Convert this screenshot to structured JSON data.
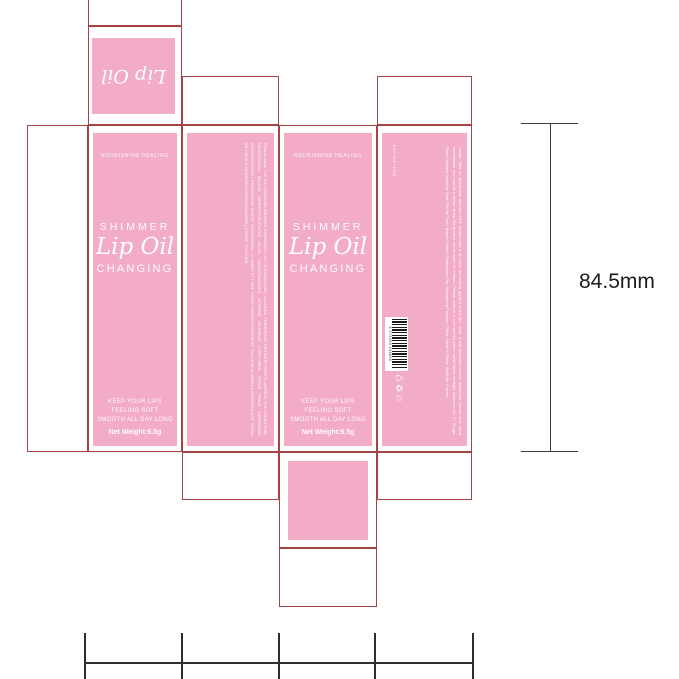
{
  "colors": {
    "panel_pink": "#F2ACC8",
    "dieline_red": "#a54444",
    "dimension_gray": "#3a3a3a"
  },
  "top_flap": {
    "brand_script": "Lip Oil"
  },
  "front_panel": {
    "tagline": "NOURISHING HEALING",
    "shimmer": "SHIMMER",
    "brand_script": "Lip Oil",
    "changing": "CHANGING",
    "claims": [
      "KEEP YOUR LIPS",
      "FEELING SOFT",
      "SMOOTH ALL DAY LONG"
    ],
    "net_weight": "Net Weight:6.5g"
  },
  "ingredients_panel": {
    "text": "Product name : LIP OIL CHANGING SHIMMER   INGREDIENT: OCTYLDODECANOL, ALCOHOL, TRIBEHENIN, PENTAERYTHRITYL ADIPATE, POLYISOBUTENE, DIISOSTEARYL MALATE, DIMETHYLSILYLATED SILICA, DIISOSTEARATES, STYRENE ISOPRENE COPOLYMER, OTHER TRACE INGREDIENT: HYDROXYPHENYL PROPIONATE ESTER, TOCOPHEROL, CI 15850, CI 77491, FOOD FLAVOR   INGREDIENT: CALCIUM ALUMINUM BOROSILICATE, TETRA (DI-T-BUTYL HYDROXYHYDROCINNAMATE), ESTER, TIN OXIDE"
  },
  "info_panel": {
    "usage_text": "Usage: Take an appropriate amount of this product with a lip brush and evenly apply it to the lips. Note: If any discomfort occurs during use, please stop using immediately and consult a doctor. Keep this product out of reach of children. Please store in a cool and dry place, avoid direct sunlight. Address: No. 17 Xingye Road, Xinhang Industrial Zone, Renhe Town, Baiyun District, Guangzhou City, Guangdong Province, China. Made in China. Shelf life: 3 years.",
    "exp_code": "EXP:20271006",
    "barcode_digits": "6 972493 216890",
    "icons": {
      "green_dot": "♺",
      "recycle": "♻",
      "dispose": "♲"
    }
  },
  "dimensions": {
    "height_label": "84.5mm"
  }
}
